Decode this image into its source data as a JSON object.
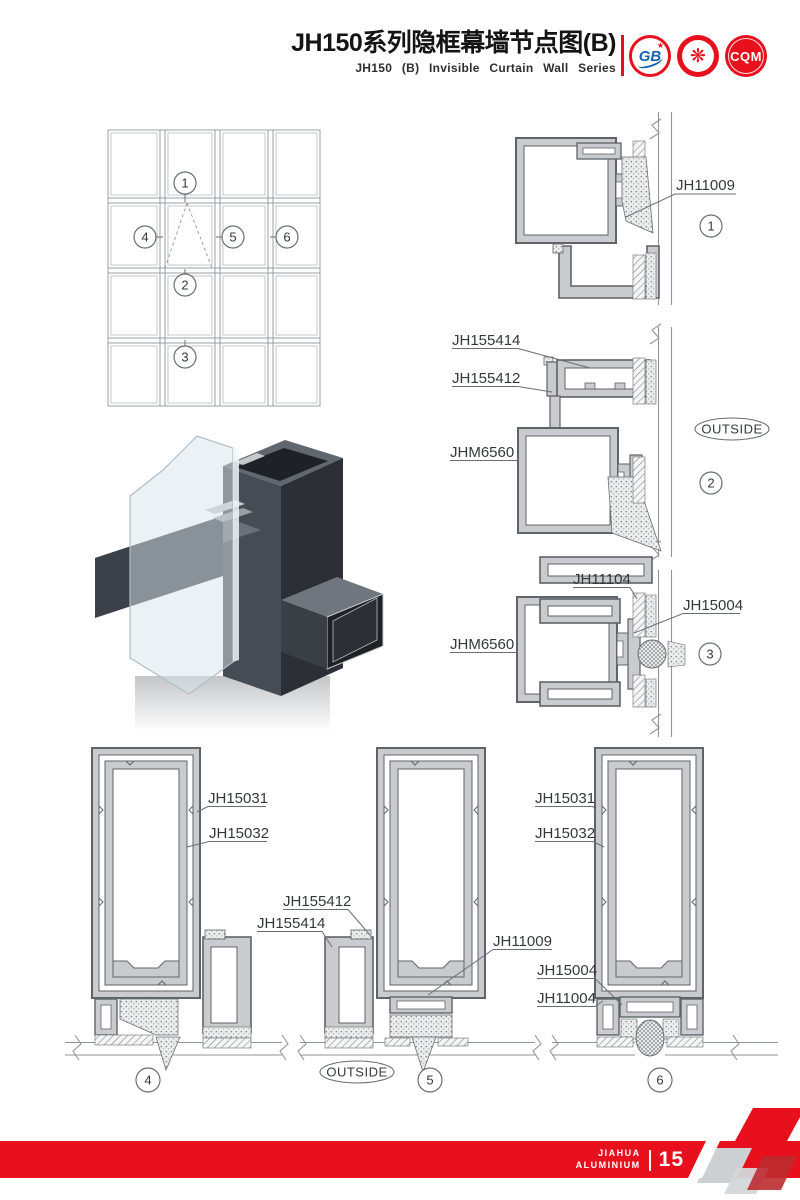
{
  "header": {
    "title_cn": "JH150系列隐框幕墙节点图(B)",
    "title_en": "JH150 (B) Invisible Curtain Wall Series",
    "logo_gb_text": "GB",
    "logo_seal_glyph": "❋",
    "logo_cqm_text": "CQM"
  },
  "elevation": {
    "callout_1": "1",
    "callout_2": "2",
    "callout_3": "3",
    "callout_4": "4",
    "callout_5": "5",
    "callout_6": "6"
  },
  "d1": {
    "num": "1",
    "jh11009": "JH11009"
  },
  "d2": {
    "num": "2",
    "jh155414": "JH155414",
    "jh155412": "JH155412",
    "jhm6560": "JHM6560",
    "outside": "OUTSIDE"
  },
  "d3": {
    "num": "3",
    "jh11104": "JH11104",
    "jh15004": "JH15004",
    "jhm6560": "JHM6560"
  },
  "d4": {
    "num": "4",
    "jh15031": "JH15031",
    "jh15032": "JH15032"
  },
  "d5": {
    "num": "5",
    "jh155412": "JH155412",
    "jh155414": "JH155414",
    "jh11009": "JH11009",
    "outside": "OUTSIDE"
  },
  "d6": {
    "num": "6",
    "jh15031": "JH15031",
    "jh15032": "JH15032",
    "jh15004": "JH15004",
    "jh11004": "JH11004"
  },
  "footer": {
    "brand_line1": "JIAHUA",
    "brand_line2": "ALUMINIUM",
    "page_number": "15"
  },
  "colors": {
    "accent_red": "#e8101c",
    "drawing_line": "#6a6e72",
    "profile_fill": "#c9cbce"
  }
}
